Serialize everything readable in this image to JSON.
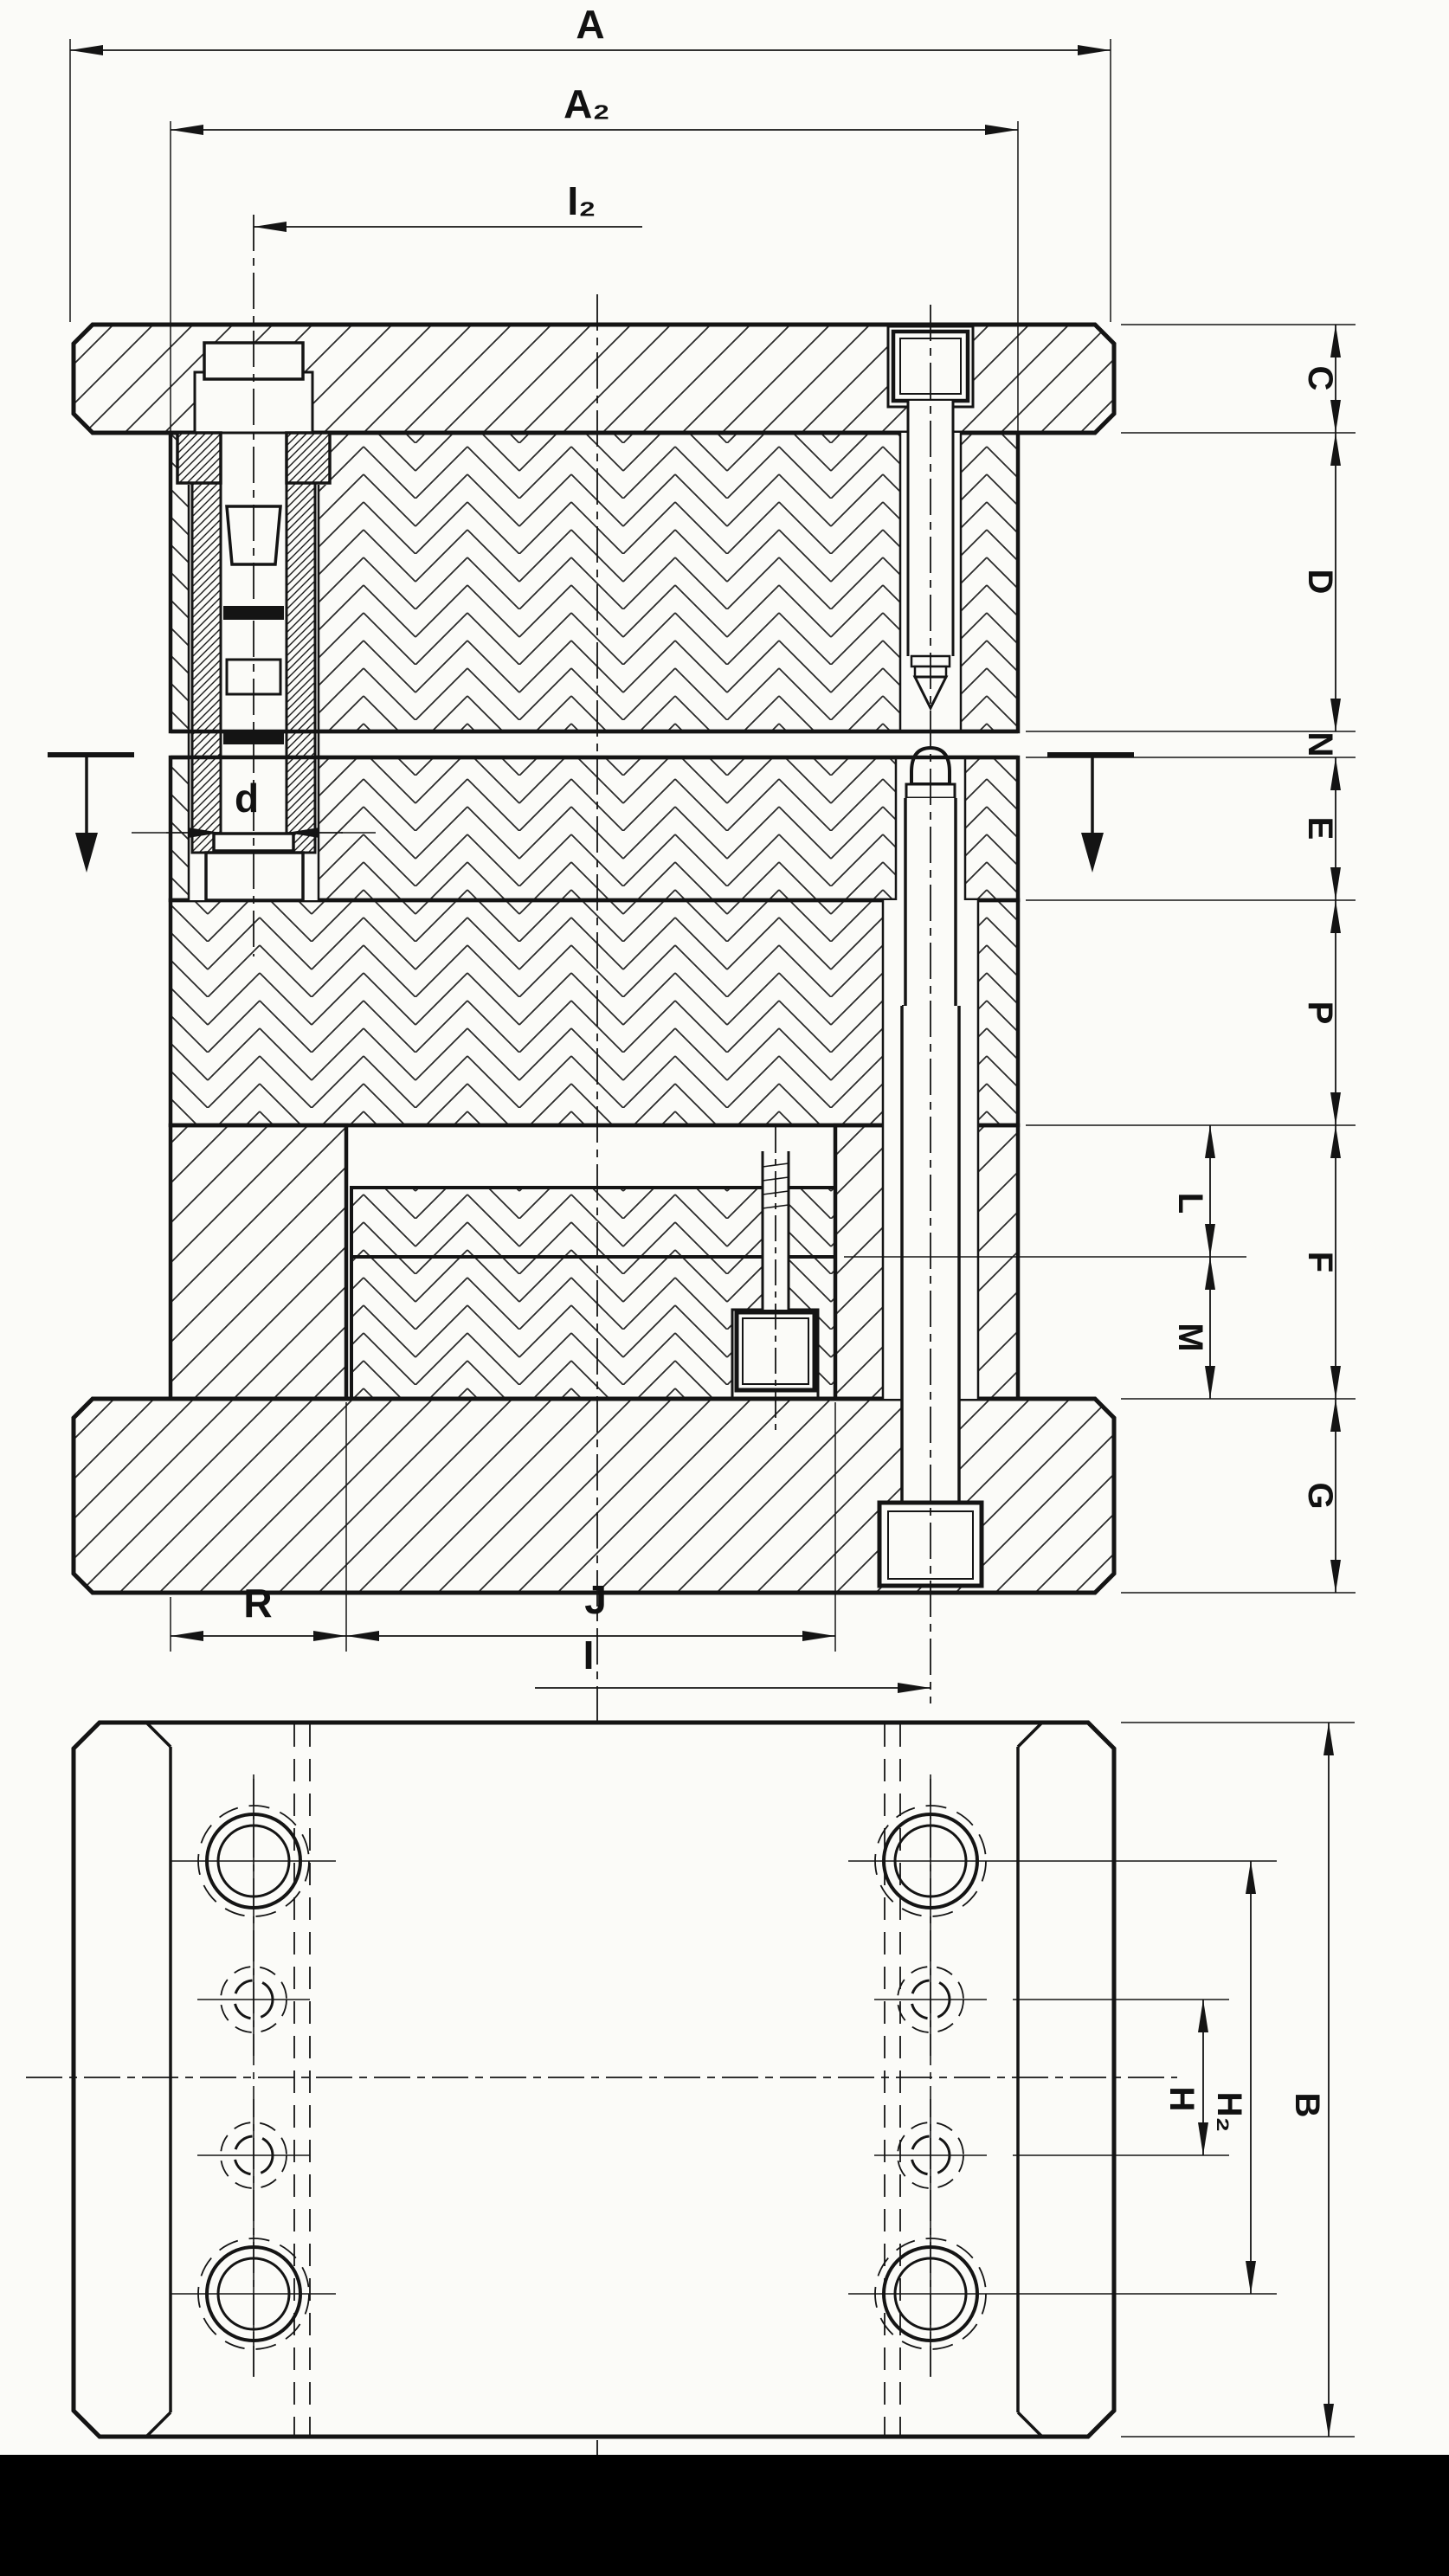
{
  "drawing": {
    "type": "technical-drawing",
    "description": "Sectional elevation and plan view of a two-pillar die set with guide bushing, guide pin, cap screws and plate stack",
    "paper_color": "#fbfbf8",
    "ink_color": "#141414",
    "views": [
      {
        "name": "sectional-elevation",
        "position": "top"
      },
      {
        "name": "plan-view",
        "position": "bottom"
      }
    ]
  },
  "labels": {
    "a": "A",
    "a2": "A₂",
    "i2": "I₂",
    "d": "d",
    "c": "C",
    "dd": "D",
    "n": "N",
    "e": "E",
    "p": "P",
    "f": "F",
    "l": "L",
    "m": "M",
    "g": "G",
    "r": "R",
    "j": "J",
    "i": "I",
    "h": "H",
    "h2": "H₂",
    "b": "B"
  }
}
